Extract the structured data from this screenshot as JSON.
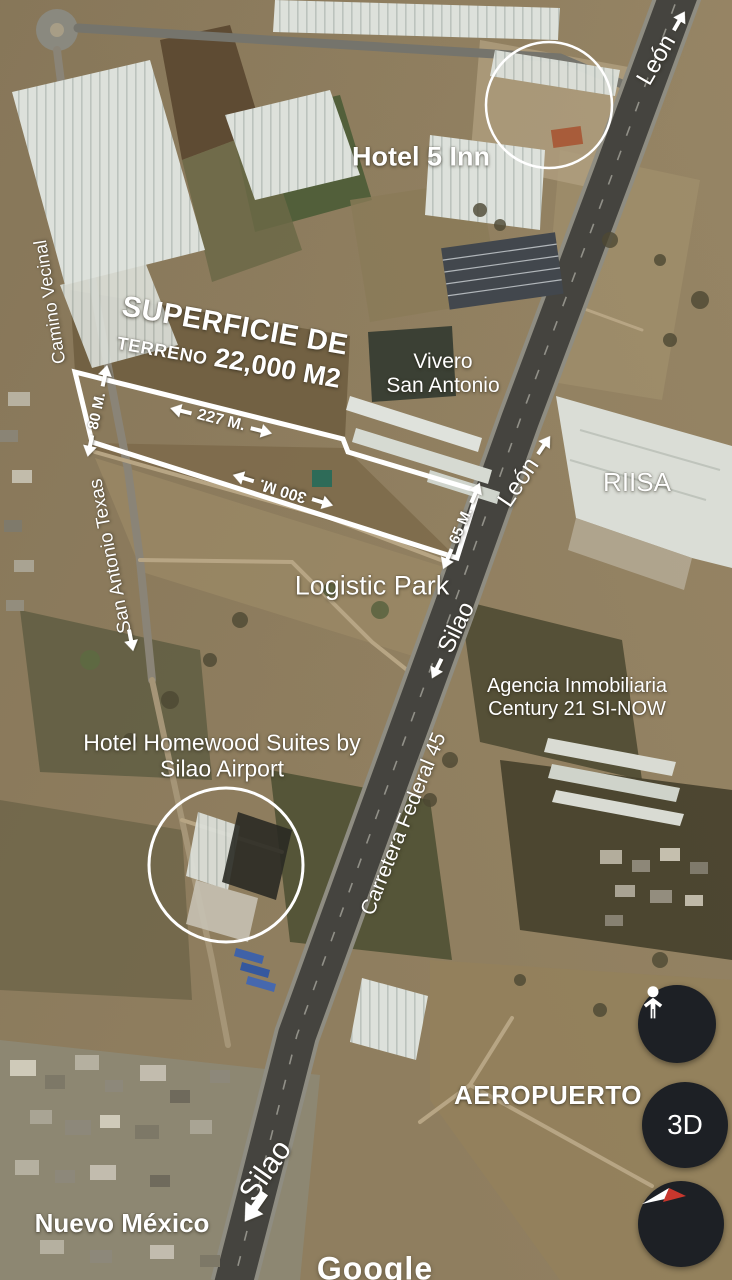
{
  "map": {
    "attribution": "Google",
    "annotations": {
      "hotel_5_inn": "Hotel 5 Inn",
      "superficie_line1": "SUPERFICIE DE",
      "terreno_prefix": "TERRENO",
      "terreno_value": "22,000 M2",
      "dim_left": "80 M.",
      "dim_top": "227 M.",
      "dim_bottom": "300 M.",
      "dim_right": "65 M.",
      "hotel_homewood_line1": "Hotel Homewood Suites by",
      "hotel_homewood_line2": "Silao Airport"
    },
    "places": {
      "vivero_line1": "Vivero",
      "vivero_line2": "San Antonio",
      "riisa": "RIISA",
      "logistic_park": "Logistic Park",
      "agencia_line1": "Agencia Inmobiliaria",
      "agencia_line2": "Century 21 SI-NOW",
      "aeropuerto": "AEROPUERTO",
      "nuevo_mexico": "Nuevo México"
    },
    "roads": {
      "leon_top": "León",
      "leon_mid": "León",
      "silao_mid": "Silao",
      "silao_bottom": "Silao",
      "carretera_federal": "Carretera Federal 45",
      "camino_vecinal": "Camino Vecinal",
      "san_antonio_texas": "San Antonio Texas"
    },
    "controls": {
      "view_3d": "3D"
    },
    "icons": {
      "pegman": "street-view-pegman-icon",
      "compass": "compass-needle-icon"
    },
    "colors": {
      "annotation_white": "#ffffff",
      "control_background": "#1d2025",
      "compass_red": "#c8372d"
    }
  }
}
